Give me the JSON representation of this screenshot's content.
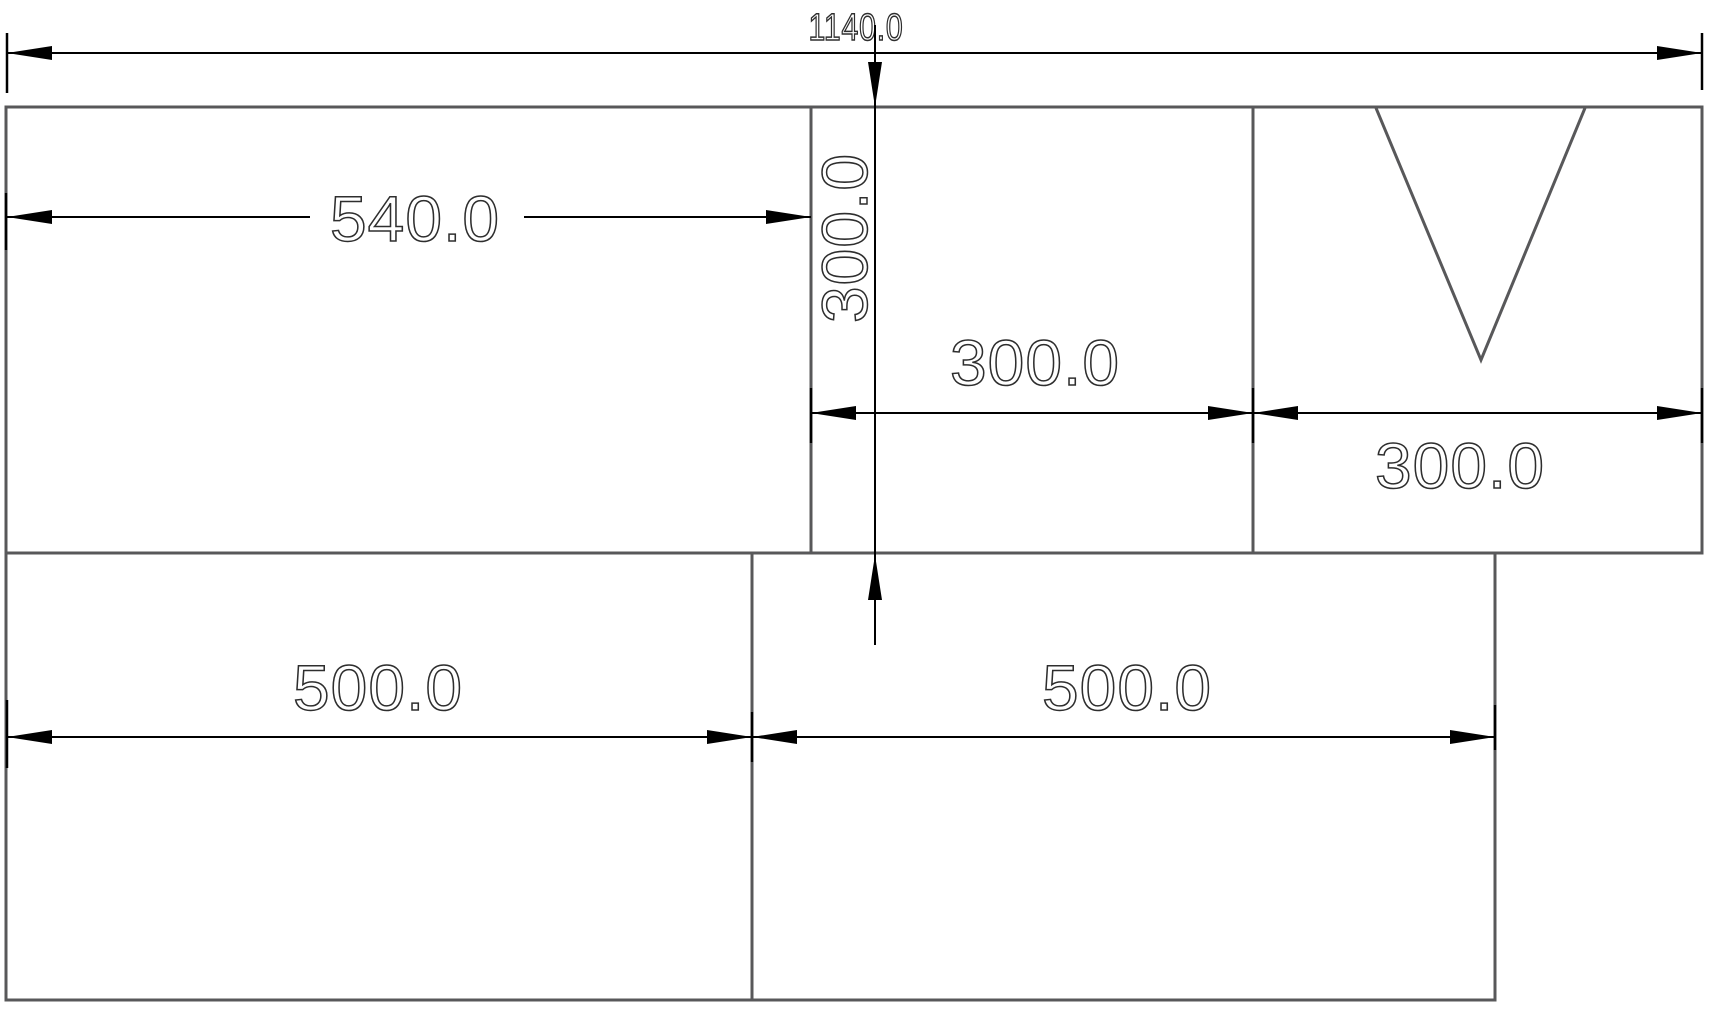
{
  "drawing": {
    "title": "panel-cutting-layout-drawing",
    "background": "#ffffff"
  },
  "labels": {
    "overall_width": "1140.0",
    "top_left_width": "540.0",
    "top_height": "300.0",
    "top_middle_width": "300.0",
    "top_right_width": "300.0",
    "bottom_left_width": "500.0",
    "bottom_right_width": "500.0"
  },
  "colors": {
    "panel_outline": "#58585a",
    "dimension_line": "#000000",
    "label_stroke": "#2e2e2e",
    "background": "#ffffff"
  }
}
